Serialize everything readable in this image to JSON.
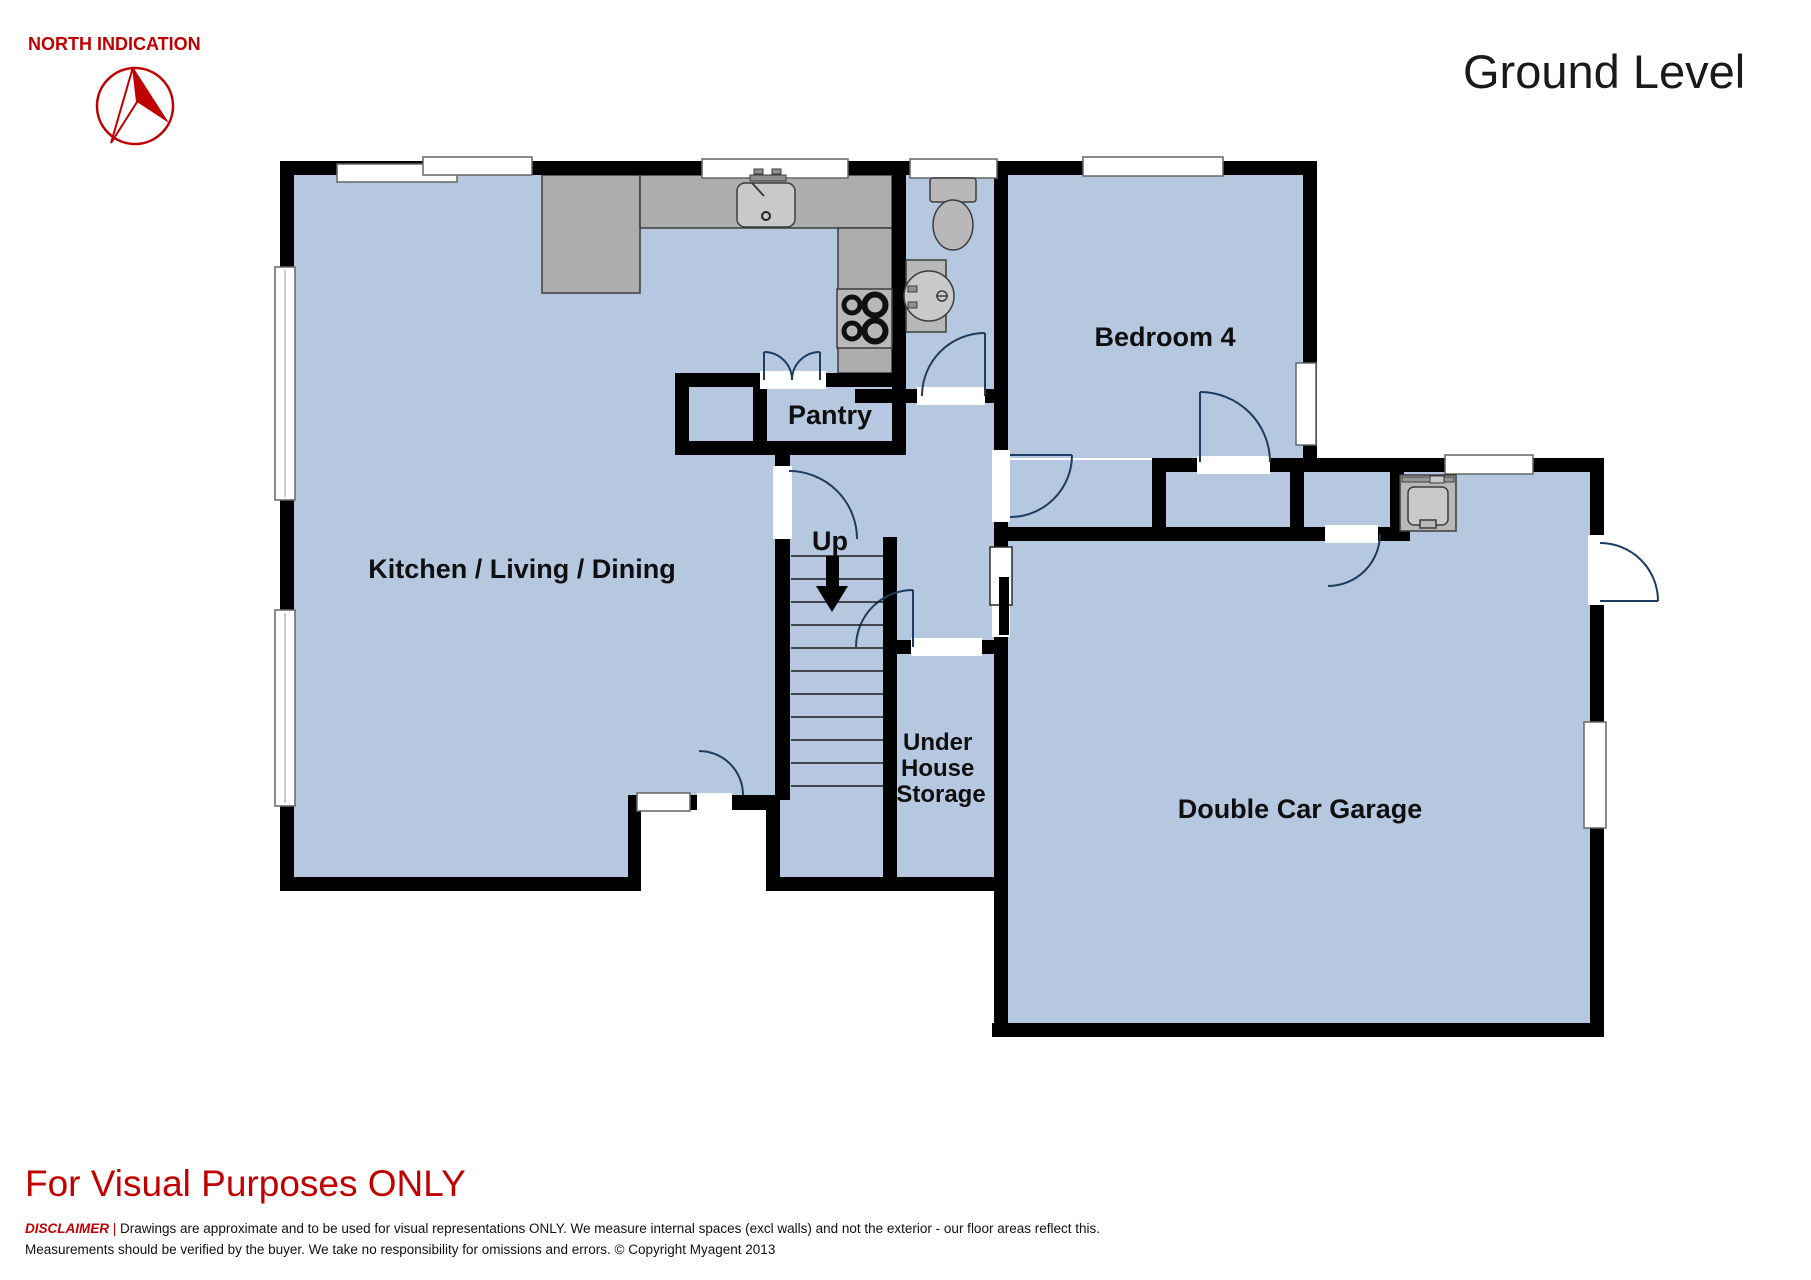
{
  "header": {
    "north_label": "NORTH INDICATION",
    "title": "Ground Level"
  },
  "rooms": {
    "kitchen_living_dining": "Kitchen / Living / Dining",
    "pantry": "Pantry",
    "bedroom4": "Bedroom 4",
    "up": "Up",
    "under_house_storage": [
      "Under",
      "House",
      "Storage"
    ],
    "garage": "Double Car Garage"
  },
  "footer": {
    "visual_notice": "For Visual Purposes ONLY",
    "disclaimer_label": "DISCLAIMER",
    "disclaimer_sep": " | ",
    "disclaimer_line1": "Drawings are approximate and to be used for visual representations ONLY. We measure internal spaces (excl walls) and not the exterior - our floor areas reflect this.",
    "disclaimer_line2": "Measurements should be verified by the buyer. We take no responsibility for omissions and errors. © Copyright Myagent 2013"
  },
  "colors": {
    "floor": "#b5c8e0",
    "wall": "#000000",
    "counter": "#adadad",
    "fixture": "#b8b8b8",
    "accent_red": "#c00000",
    "door_arc": "#1d3c5f",
    "window_stroke": "#666666"
  }
}
